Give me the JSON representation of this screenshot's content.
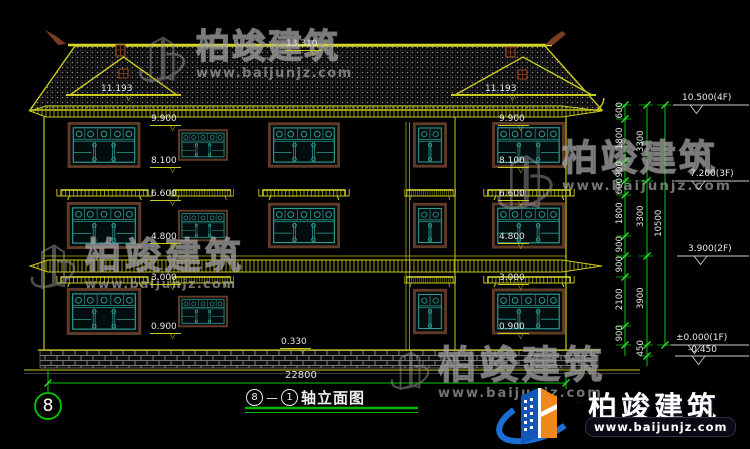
{
  "drawing": {
    "title": {
      "axis_start": "8",
      "separator": "—",
      "axis_end": "1",
      "label": "轴立面图"
    },
    "axis_bubble_label": "8",
    "overall_width_dim": "22800",
    "levels": {
      "ridge": "13.310",
      "gable_left": "11.193",
      "gable_right": "11.193",
      "plinth": "0.330",
      "left_column": [
        "9.900",
        "8.100",
        "6.600",
        "4.800",
        "3.000",
        "0.900"
      ],
      "right_column": [
        "9.900",
        "8.100",
        "6.600",
        "4.800",
        "3.000",
        "0.900"
      ]
    },
    "elevation_flags": [
      "10.500(4F)",
      "7.200(3F)",
      "3.900(2F)",
      "±0.000(1F)",
      "-0.450"
    ],
    "dim_segments_inner": [
      "600",
      "1800",
      "900",
      "600",
      "1800",
      "900",
      "900",
      "2100",
      "900"
    ],
    "dim_segments_middle": [
      "3300",
      "3300",
      "3900",
      "450"
    ],
    "dim_overall": "10500"
  },
  "watermark": {
    "company": "柏竣建筑",
    "website": "www.baijunjz.com"
  },
  "brand": {
    "company": "柏竣建筑",
    "website": "www.baijunjz.com"
  },
  "colors": {
    "background": "#000000",
    "cad_yellow": "#c9c91e",
    "window_teal": "#2e9c94",
    "frame_brown": "#5f3a26",
    "dim_green": "#00c800",
    "text_white": "#e6e6e6",
    "logo_blue": "#1a6fd4",
    "logo_orange": "#f0881c"
  }
}
